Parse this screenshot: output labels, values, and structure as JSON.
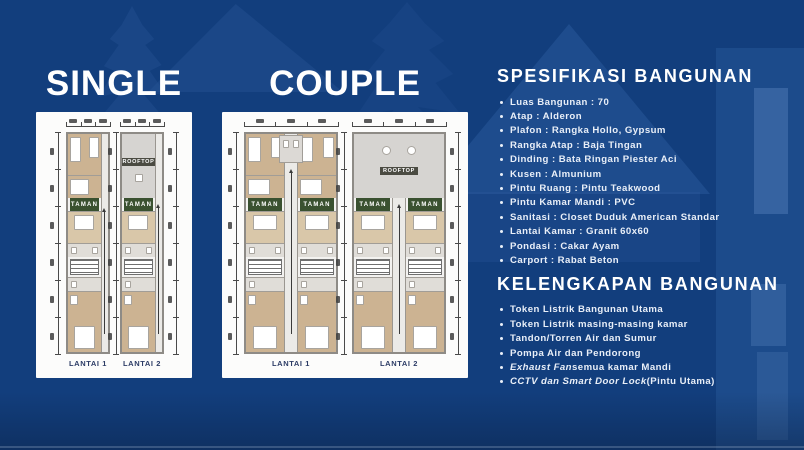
{
  "titles": {
    "single": "SINGLE",
    "couple": "COUPLE"
  },
  "spec": {
    "heading": "SPESIFIKASI BANGUNAN",
    "items": [
      "Luas Bangunan : 70",
      "Atap : Alderon",
      "Plafon : Rangka Hollo, Gypsum",
      "Rangka Atap : Baja Tingan",
      "Dinding : Bata Ringan Piester Aci",
      "Kusen : Almunium",
      "Pintu Ruang : Pintu Teakwood",
      "Pintu Kamar Mandi : PVC",
      "Sanitasi : Closet Duduk American Standar",
      "Lantai Kamar : Granit 60x60",
      "Pondasi : Cakar Ayam",
      "Carport : Rabat Beton"
    ]
  },
  "kelengkapan": {
    "heading": "KELENGKAPAN BANGUNAN",
    "items": [
      [
        {
          "t": "Token Listrik Bangunan Utama"
        }
      ],
      [
        {
          "t": "Token Listrik masing-masing kamar"
        }
      ],
      [
        {
          "t": "Tandon/Torren Air dan Sumur"
        }
      ],
      [
        {
          "t": "Pompa Air dan Pendorong"
        }
      ],
      [
        {
          "t": "Exhaust Fan",
          "i": true
        },
        {
          "t": " semua kamar Mandi"
        }
      ],
      [
        {
          "t": "CCTV dan Smart Door Lock",
          "i": true
        },
        {
          "t": " (Pintu Utama)"
        }
      ]
    ]
  },
  "plans": {
    "taman_label": "TAMAN",
    "rooftop_label": "ROOFTOP",
    "single": {
      "floors": [
        "LANTAI 1",
        "LANTAI 2"
      ]
    },
    "couple": {
      "floors": [
        "LANTAI 1",
        "LANTAI 2"
      ]
    }
  },
  "colors": {
    "background": "#123E7D",
    "card_white": "#FCFCFB",
    "taman_green": "#3A5130",
    "wood_tan": "#CCB392",
    "rooftop_gray": "#D6D4D1",
    "text_white": "#FFFFFF",
    "floor_label_navy": "#2C3C66"
  }
}
